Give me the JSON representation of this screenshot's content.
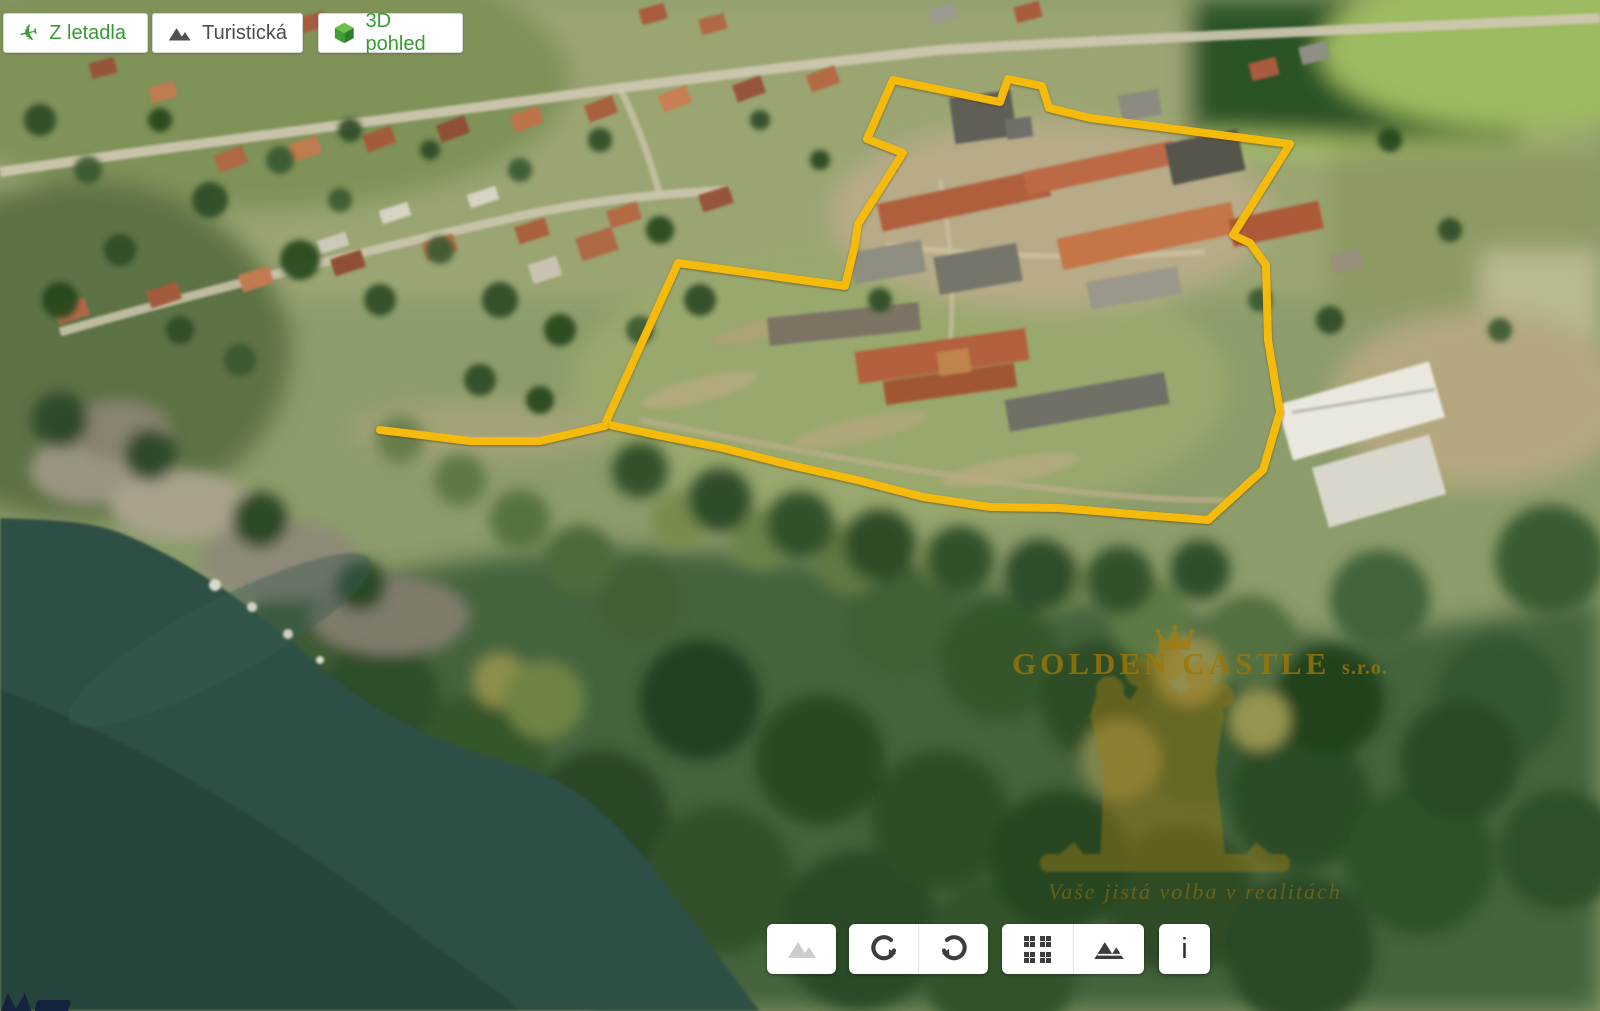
{
  "top_buttons": [
    {
      "id": "aerial",
      "label": "Z letadla",
      "icon": "airplane-icon"
    },
    {
      "id": "tourist",
      "label": "Turistická",
      "icon": "mountains-icon"
    },
    {
      "id": "view3d",
      "label": "3D pohled",
      "icon": "cube-3d-icon"
    }
  ],
  "bottom_toolbar": {
    "photos_icon": "mountains-icon-light",
    "rotate_ccw_icon": "rotate-counterclockwise-icon",
    "rotate_cw_icon": "rotate-clockwise-icon",
    "layers_grid_icon": "grid-icon",
    "layers_map_icon": "mountains-icon-dark",
    "info_label": "i"
  },
  "watermark": {
    "company_name": "GOLDEN CASTLE",
    "company_suffix": "s.r.o.",
    "tagline": "Vaše jistá volba v realitách",
    "crown_icon": "crown-icon",
    "tree_emblem": "tree-emblem",
    "gold_color": "#a07c12"
  },
  "map": {
    "boundary_color": "#f5bb0c",
    "property_boundary_points": "893,80 1000,102 1008,79 1042,86 1049,108 1090,118 1290,144 1233,235 1250,243 1266,265 1268,340 1280,412 1263,470 1208,520 1143,515 1060,508 990,507 923,497 857,480 790,465 723,448 657,435 605,424 678,263 845,286 855,245 858,224 903,153 867,139",
    "access_spur_points": "605,426 540,441 470,441 380,430"
  },
  "colors": {
    "water": "#2d4f45",
    "forest_dark": "#2b4a26",
    "village_ground": "#97a470",
    "ui_green": "#379a33"
  }
}
